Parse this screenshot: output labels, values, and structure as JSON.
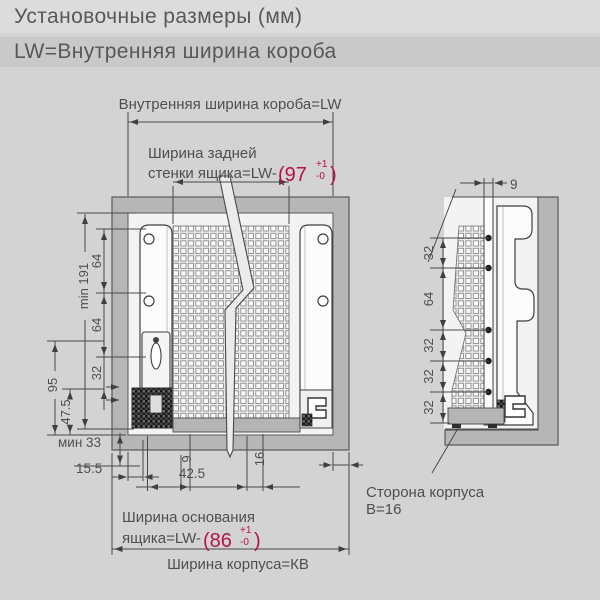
{
  "header": {
    "line1": "Установочные размеры (мм)",
    "line2": "LW=Внутренняя ширина короба"
  },
  "colors": {
    "accent_red": "#b81245",
    "background": "#d3d3d3",
    "cabinet_gray": "#b6b6b6",
    "line_gray": "#4a4a4a"
  },
  "main": {
    "top_width_label": "Внутренняя ширина короба=LW",
    "back_wall": {
      "label_line1": "Ширина задней",
      "label_line2": "стенки ящика=LW-",
      "value": "(97",
      "tol_plus": "+1",
      "tol_minus": "-0",
      "close": ")"
    },
    "left_dims": {
      "min191": "min 191",
      "d64a": "64",
      "d64b": "64",
      "d32": "32",
      "d95": "95",
      "d47_5": "47.5",
      "min33": "мин 33",
      "d15_5": "15.5"
    },
    "bottom_dims": {
      "d42_5": "42.5",
      "d9": "9",
      "d16": "16"
    },
    "base": {
      "label_line1": "Ширина основания",
      "label_line2": "ящика=LW-",
      "value": "(86",
      "tol_plus": "+1",
      "tol_minus": "-0",
      "close": ")"
    },
    "cabinet_width_label": "Ширина корпуса=КВ"
  },
  "right": {
    "d9": "9",
    "dims": [
      "32",
      "64",
      "32",
      "32",
      "32"
    ],
    "side_label_line1": "Сторона корпуса",
    "side_label_line2": "В=16"
  }
}
